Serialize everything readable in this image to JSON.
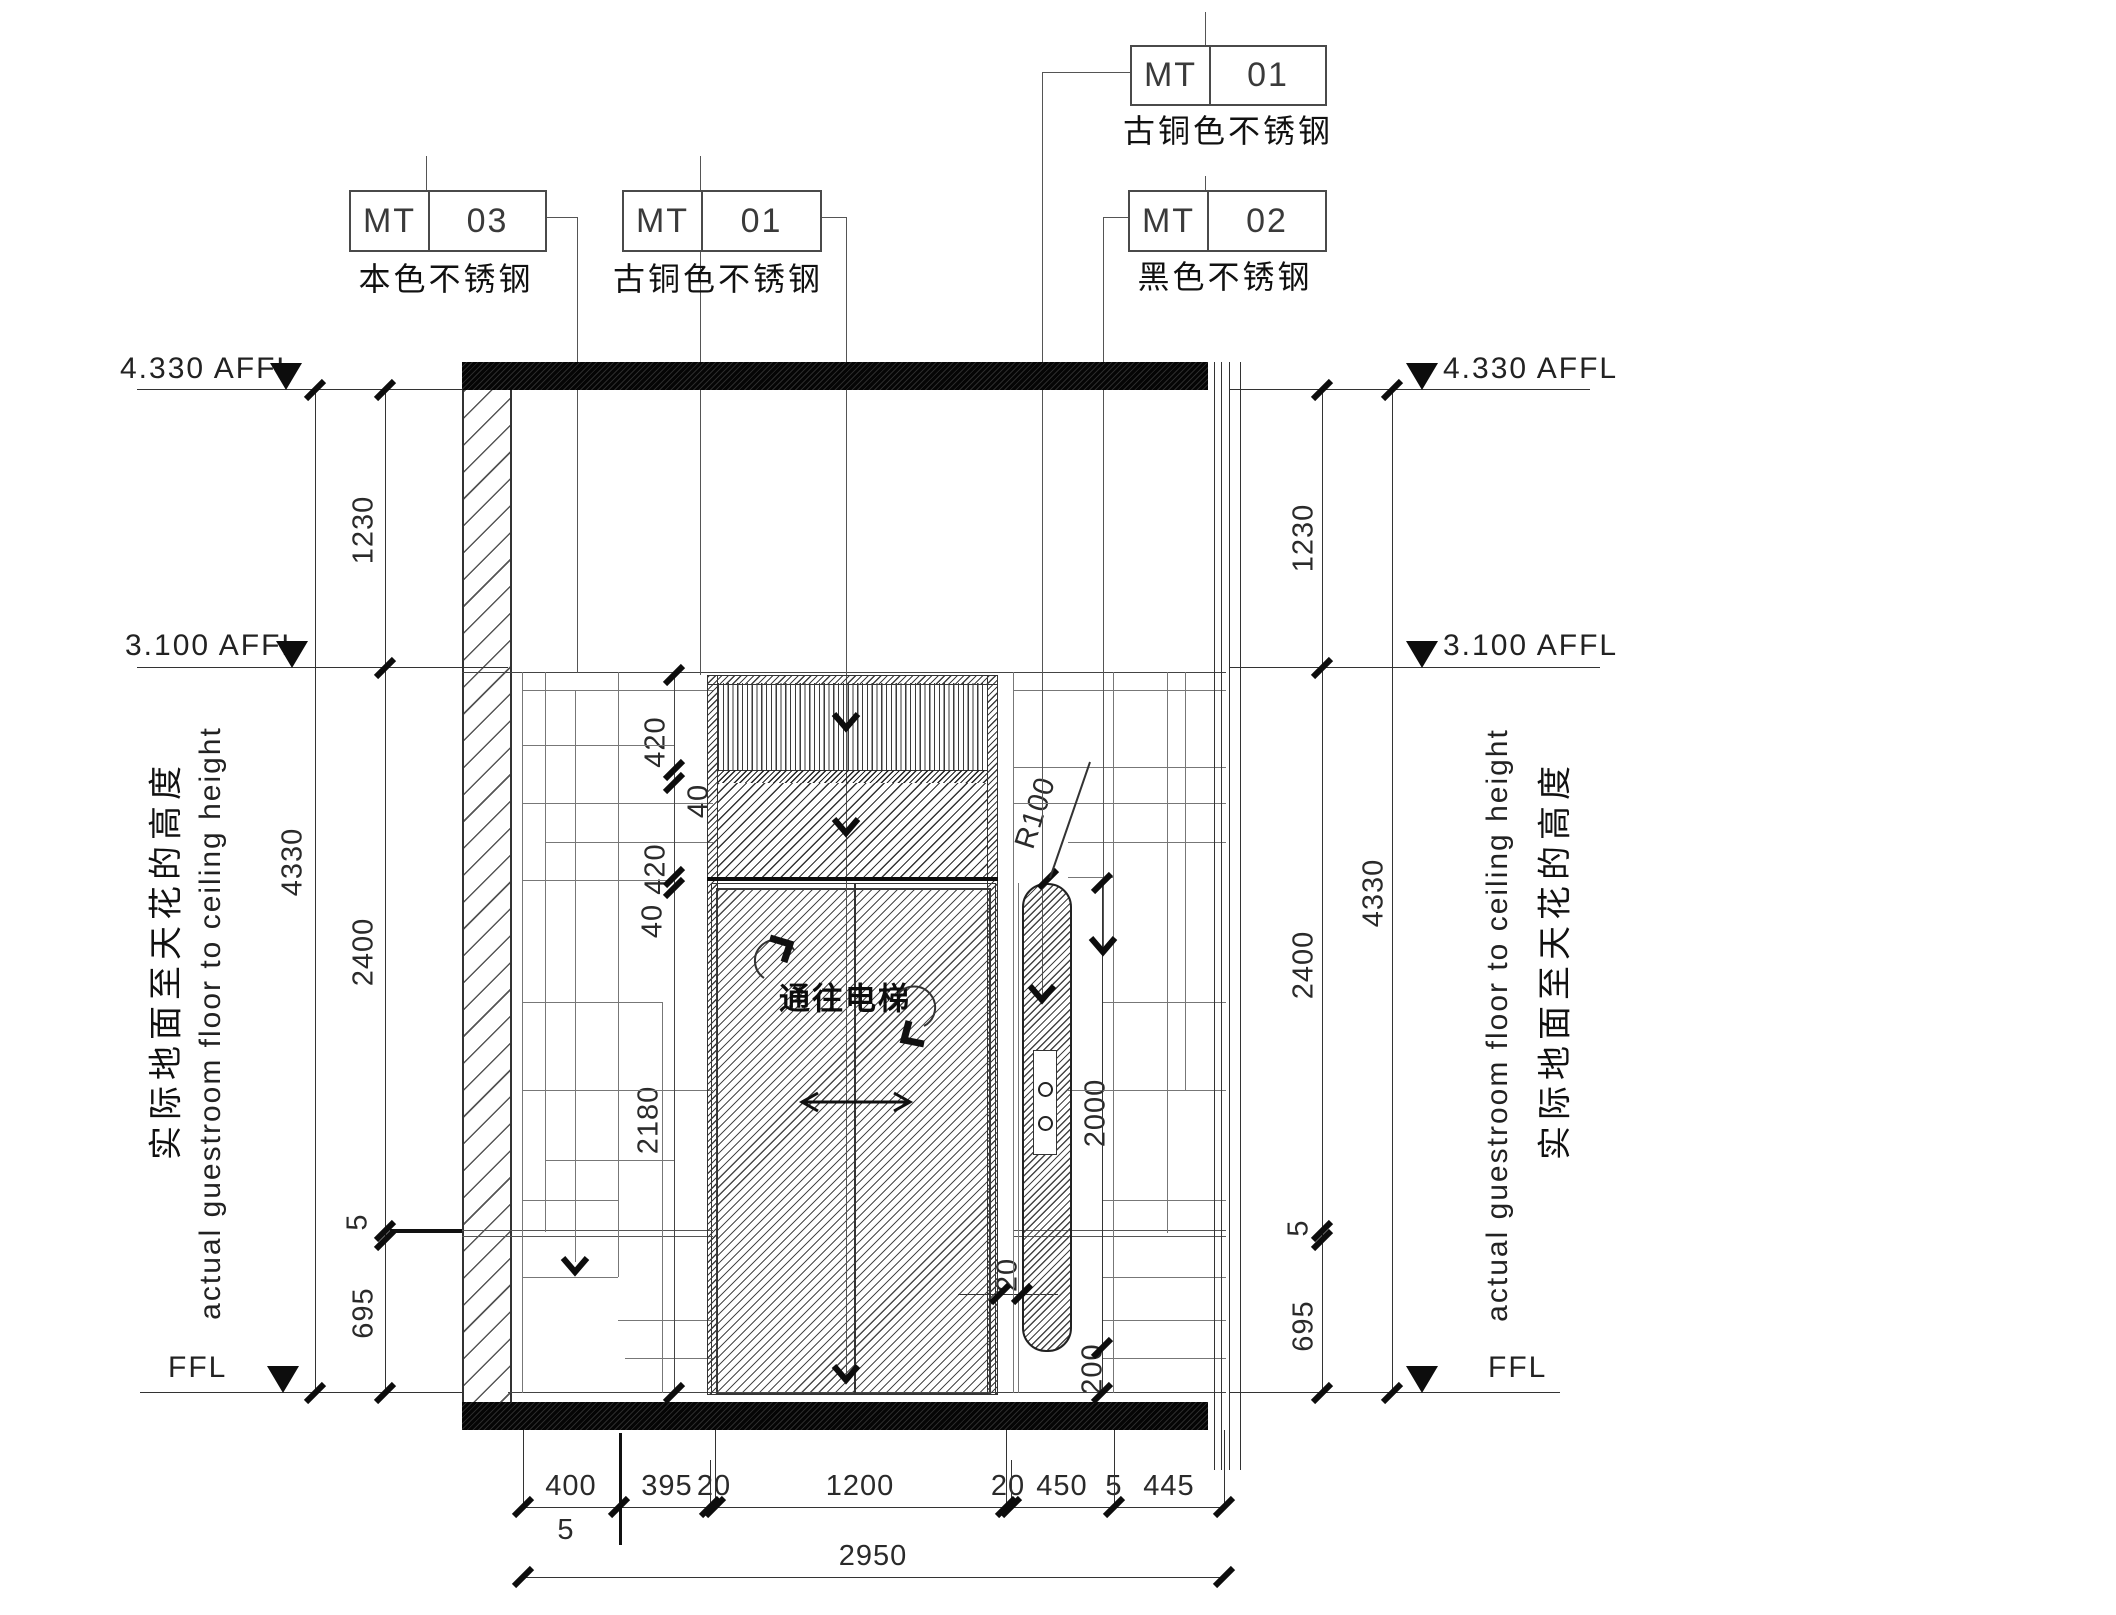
{
  "material_tags": [
    {
      "code": "MT",
      "num": "03",
      "desc": "本色不锈钢"
    },
    {
      "code": "MT",
      "num": "01",
      "desc": "古铜色不锈钢"
    },
    {
      "code": "MT",
      "num": "01",
      "desc": "古铜色不锈钢"
    },
    {
      "code": "MT",
      "num": "02",
      "desc": "黑色不锈钢"
    }
  ],
  "levels": {
    "top": "4.330 AFFL",
    "middle": "3.100 AFFL",
    "floor": "FFL"
  },
  "side_notes": {
    "cn": "实际地面至天花的高度",
    "en": "actual guestroom floor to ceiling height"
  },
  "dimensions": {
    "side_chain": [
      "1230",
      "2400",
      "5",
      "695"
    ],
    "side_total": "4330",
    "inner_chain": [
      "420",
      "40",
      "420",
      "40",
      "2180"
    ],
    "bottom": {
      "segments": [
        "400",
        "395",
        "20",
        "1200",
        "20",
        "450",
        "5",
        "445"
      ],
      "below": "5",
      "total": "2950"
    },
    "handle": {
      "radius": "R100",
      "height": "2000",
      "bottom": "200",
      "gap": "20"
    }
  },
  "door_sign": "通往电梯"
}
